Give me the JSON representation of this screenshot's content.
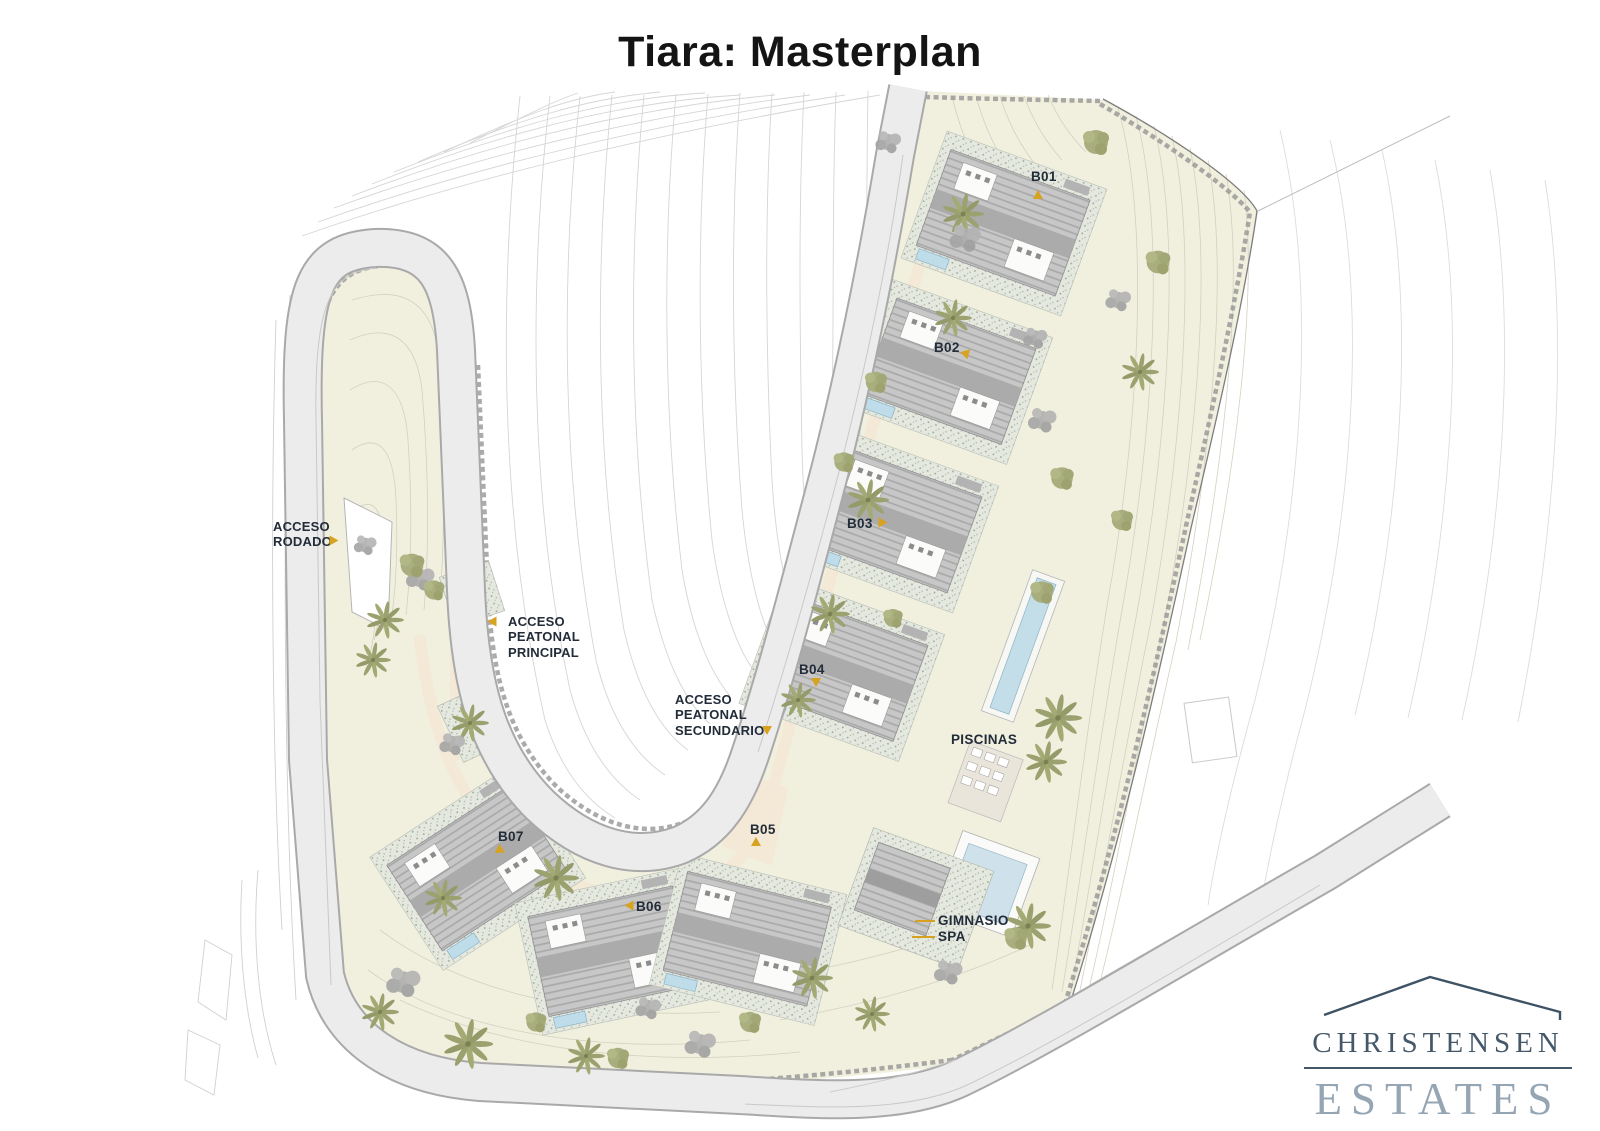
{
  "title": "Tiara: Masterplan",
  "plan": {
    "building_markers": [
      {
        "label": "B01"
      },
      {
        "label": "B02"
      },
      {
        "label": "B03"
      },
      {
        "label": "B04"
      },
      {
        "label": "B05"
      },
      {
        "label": "B06"
      },
      {
        "label": "B07"
      }
    ],
    "access_points": [
      {
        "label": "ACCESO RODADO"
      },
      {
        "label": "ACCESO PEATONAL PRINCIPAL"
      },
      {
        "label": "ACCESO PEATONAL SECUNDARIO"
      }
    ],
    "amenities": [
      {
        "label": "PISCINAS"
      },
      {
        "label": "GIMNASIO"
      },
      {
        "label": "SPA"
      }
    ]
  },
  "logo": {
    "name": "CHRISTENSEN",
    "descriptor": "ESTATES"
  },
  "colors": {
    "title_text": "#141414",
    "label_text": "#232c39",
    "marker_accent": "#d7a21f",
    "site_fill": "#f1f0df",
    "road_fill": "#ececec",
    "pool_fill": "#c3dde9",
    "vegetation_olive": "#a2a878",
    "vegetation_gray": "#a9a9a9",
    "logo_primary": "#44586a",
    "logo_secondary": "#95a5b4"
  }
}
